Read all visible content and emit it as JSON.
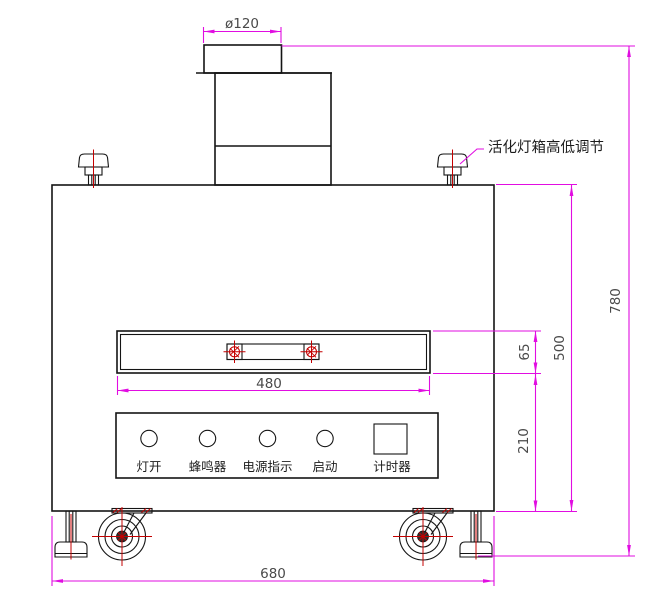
{
  "drawing": {
    "note_label": "活化灯箱高低调节",
    "dimensions": {
      "cap_diameter": "ø120",
      "total_height": "780",
      "cabinet_height": "500",
      "slot_height": "65",
      "lower_section_height": "210",
      "slot_width": "480",
      "cabinet_width": "680"
    },
    "control_panel": {
      "buttons": [
        "灯开",
        "蜂鸣器",
        "电源指示",
        "启动"
      ],
      "timer_label": "计时器"
    },
    "colors": {
      "dimension_line": "#e10de1",
      "center_line": "#c40000",
      "object_line": "#141414",
      "dimension_text": "#4a4a4a"
    }
  }
}
